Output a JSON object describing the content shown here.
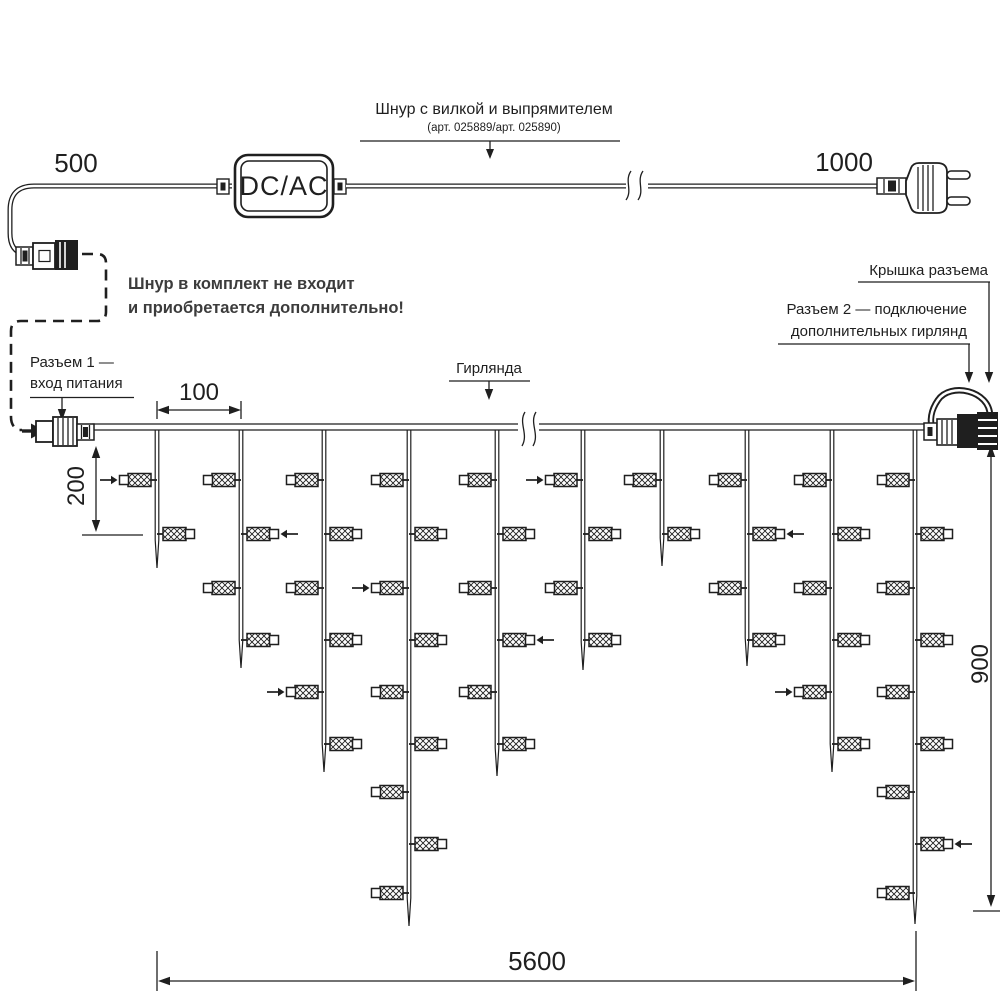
{
  "colors": {
    "ink": "#1f1f1f",
    "note": "#3c3c3c",
    "background": "#ffffff"
  },
  "power_cord": {
    "left_length": "500",
    "right_length": "1000",
    "converter": "DC/AC",
    "label": "Шнур с вилкой и выпрямителем",
    "label_articles": "(арт. 025889/арт. 025890)",
    "note_line1": "Шнур в комплект не входит",
    "note_line2": "и приобретается дополнительно!"
  },
  "callouts": {
    "connector1_line1": "Разъем 1 —",
    "connector1_line2": "вход питания",
    "garland": "Гирлянда",
    "connector_cap": "Крышка разъема",
    "connector2_line1": "Разъем 2 — подключение",
    "connector2_line2": "дополнительных гирлянд"
  },
  "dimensions": {
    "drop_spacing": "100",
    "short_drop": "200",
    "tall_drop": "900",
    "total_length": "5600"
  },
  "garland": {
    "main_line_y": 427,
    "lamp_rows_y": [
      480,
      534,
      588,
      640,
      692,
      744,
      792,
      844,
      893
    ],
    "drops": [
      {
        "x": 157,
        "lamps": 2,
        "tip_y": 568,
        "arrow_row": 1
      },
      {
        "x": 241,
        "lamps": 4,
        "tip_y": 668,
        "arrow_row": 2
      },
      {
        "x": 324,
        "lamps": 6,
        "tip_y": 772,
        "arrow_row": 5
      },
      {
        "x": 409,
        "lamps": 9,
        "tip_y": 926,
        "arrow_row": 3
      },
      {
        "x": 497,
        "lamps": 6,
        "tip_y": 776,
        "arrow_row": 4
      },
      {
        "x": 583,
        "lamps": 4,
        "tip_y": 670,
        "arrow_row": 1
      },
      {
        "x": 662,
        "lamps": 2,
        "tip_y": 566,
        "arrow_row": 0
      },
      {
        "x": 747,
        "lamps": 4,
        "tip_y": 666,
        "arrow_row": 2
      },
      {
        "x": 832,
        "lamps": 6,
        "tip_y": 772,
        "arrow_row": 5
      },
      {
        "x": 915,
        "lamps": 9,
        "tip_y": 924,
        "arrow_row": 8
      }
    ]
  }
}
